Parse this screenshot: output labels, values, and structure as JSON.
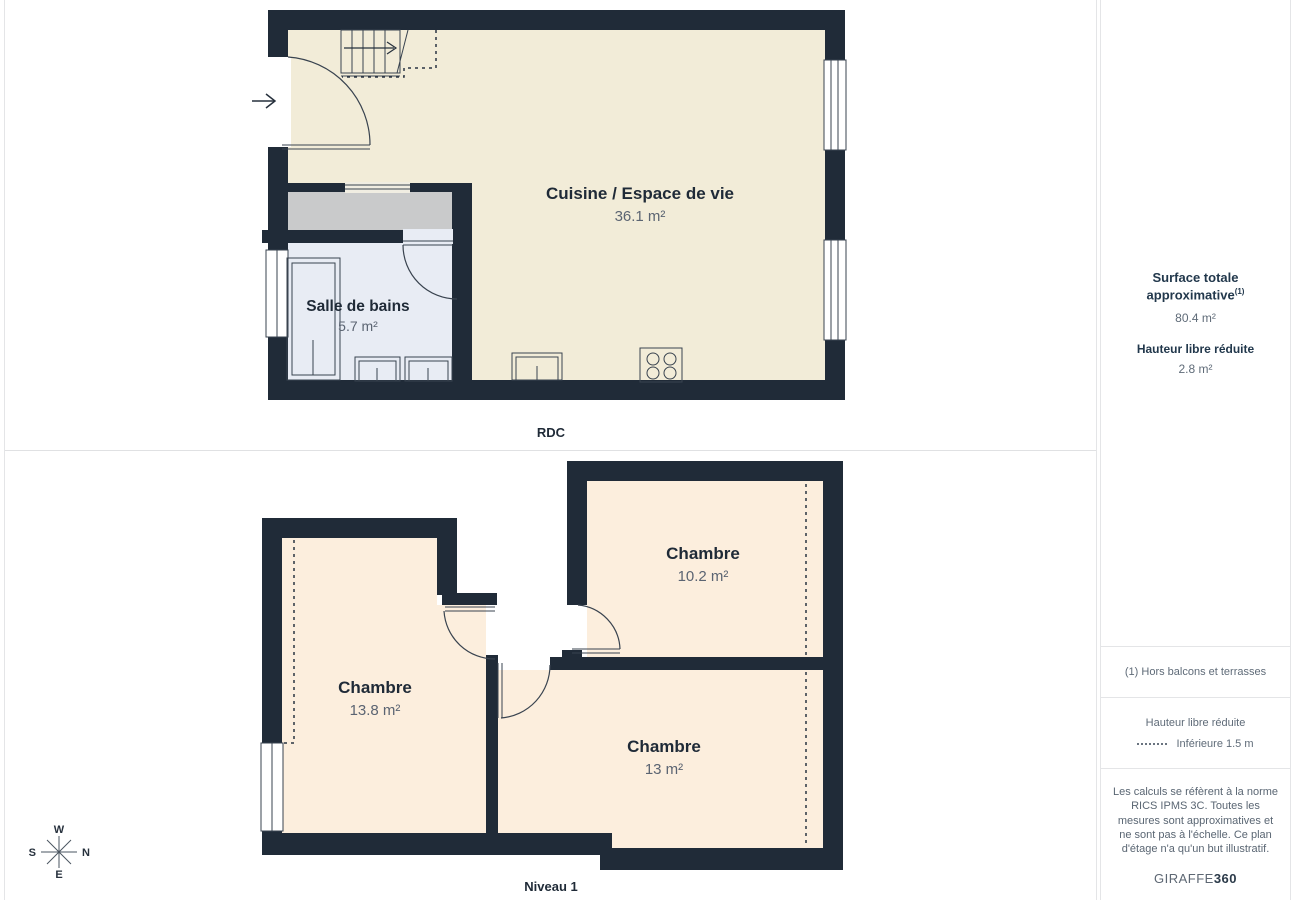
{
  "floors": {
    "rdc": {
      "label": "RDC",
      "rooms": [
        {
          "name": "Cuisine / Espace de vie",
          "area": "36.1 m²"
        },
        {
          "name": "Salle de bains",
          "area": "5.7 m²"
        }
      ]
    },
    "niveau1": {
      "label": "Niveau 1",
      "rooms": [
        {
          "name": "Chambre",
          "area": "10.2 m²"
        },
        {
          "name": "Chambre",
          "area": "13.8 m²"
        },
        {
          "name": "Chambre",
          "area": "13 m²"
        }
      ]
    }
  },
  "compass": {
    "w": "W",
    "n": "N",
    "e": "E",
    "s": "S"
  },
  "sidebar": {
    "surface_title": "Surface totale approximative",
    "surface_footnote_marker": "(1)",
    "surface_value": "80.4 m²",
    "height_title": "Hauteur libre réduite",
    "height_value": "2.8 m²",
    "footnote": "(1) Hors balcons et terrasses",
    "legend_title": "Hauteur libre réduite",
    "legend_label": "Inférieure 1.5 m",
    "disclaimer": "Les calculs se réfèrent à la norme RICS IPMS 3C. Toutes les mesures sont approximatives et ne sont pas à l'échelle. Ce plan d'étage n'a qu'un but illustratif.",
    "brand_name": "GIRAFFE",
    "brand_suffix": "360"
  },
  "colors": {
    "wall": "#202b38",
    "room_cream": "#f2ecd8",
    "room_peach": "#fceedd",
    "bathroom_blue": "#e8ecf4",
    "closet_gray": "#c9cacb",
    "text_navy": "#1f2a37",
    "text_gray": "#5b6472",
    "panel_border": "#e4e5e7"
  }
}
